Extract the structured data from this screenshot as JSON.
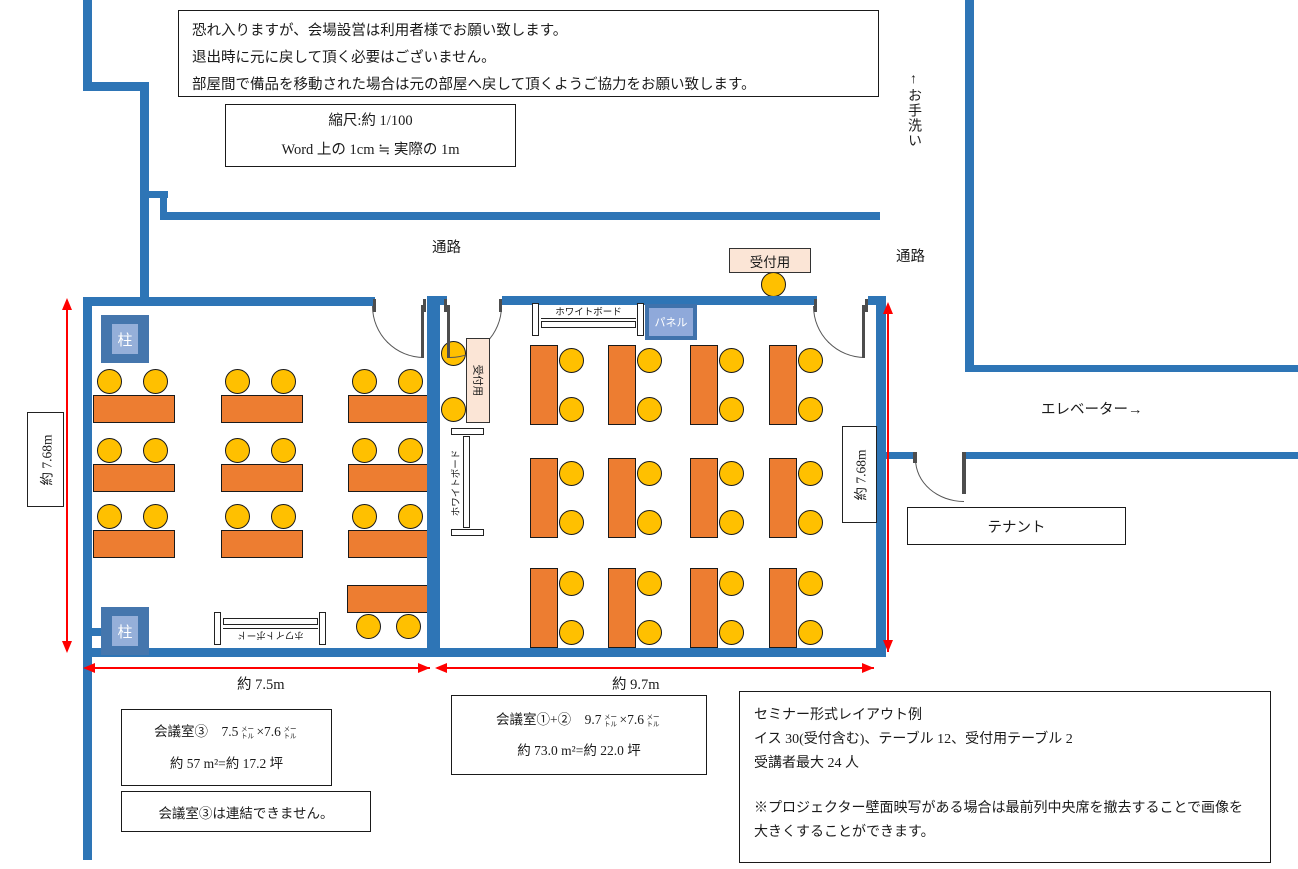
{
  "colors": {
    "wall": "#2E75B6",
    "table": "#ED7D31",
    "chair": "#FFC000",
    "reception_fill": "#FBE5D6",
    "pillar_outer": "#4576AD",
    "pillar_inner": "#95AFD9",
    "panel_inner": "#8FA9DA",
    "dimension_red": "#FF0000"
  },
  "notes": {
    "usage_lines": [
      "恐れ入りますが、会場設営は利用者様でお願い致します。",
      "退出時に元に戻して頂く必要はございません。",
      "部屋間で備品を移動された場合は元の部屋へ戻して頂くようご協力をお願い致します。"
    ],
    "scale_lines": [
      "縮尺:約 1/100",
      "Word 上の 1cm ≒ 実際の 1m"
    ]
  },
  "corridor": {
    "passage_left": "通路",
    "passage_right": "通路",
    "toilet": "↑お手洗い",
    "elevator": "エレベーター→",
    "tenant": "テナント"
  },
  "rooms": {
    "pillar": "柱",
    "panel": "パネル",
    "whiteboard": "ホワイトボード",
    "reception_table": "受付用",
    "reception_side_table": "受付用"
  },
  "dimensions": {
    "room3_height": "約 7.68m",
    "room12_height": "約 7.68m",
    "room3_width": "約 7.5m",
    "room12_width": "約 9.7m"
  },
  "info": {
    "room3_spec": {
      "title": "会議室③　7.5",
      "unit1": "メートル",
      "times": "×7.6",
      "unit2": "メートル",
      "area": "約 57 m²=約 17.2 坪"
    },
    "room3_note": "会議室③は連結できません。",
    "room12_spec": {
      "title": "会議室①+②　9.7",
      "unit1": "メートル",
      "times": "×7.6",
      "unit2": "メートル",
      "area": "約 73.0 m²=約 22.0 坪"
    },
    "seminar": {
      "line1": "セミナー形式レイアウト例",
      "line2": "イス 30(受付含む)、テーブル 12、受付用テーブル 2",
      "line3": "受講者最大 24 人",
      "note": "※プロジェクター壁面映写がある場合は最前列中央席を撤去することで画像を大きくすることができます。"
    }
  }
}
